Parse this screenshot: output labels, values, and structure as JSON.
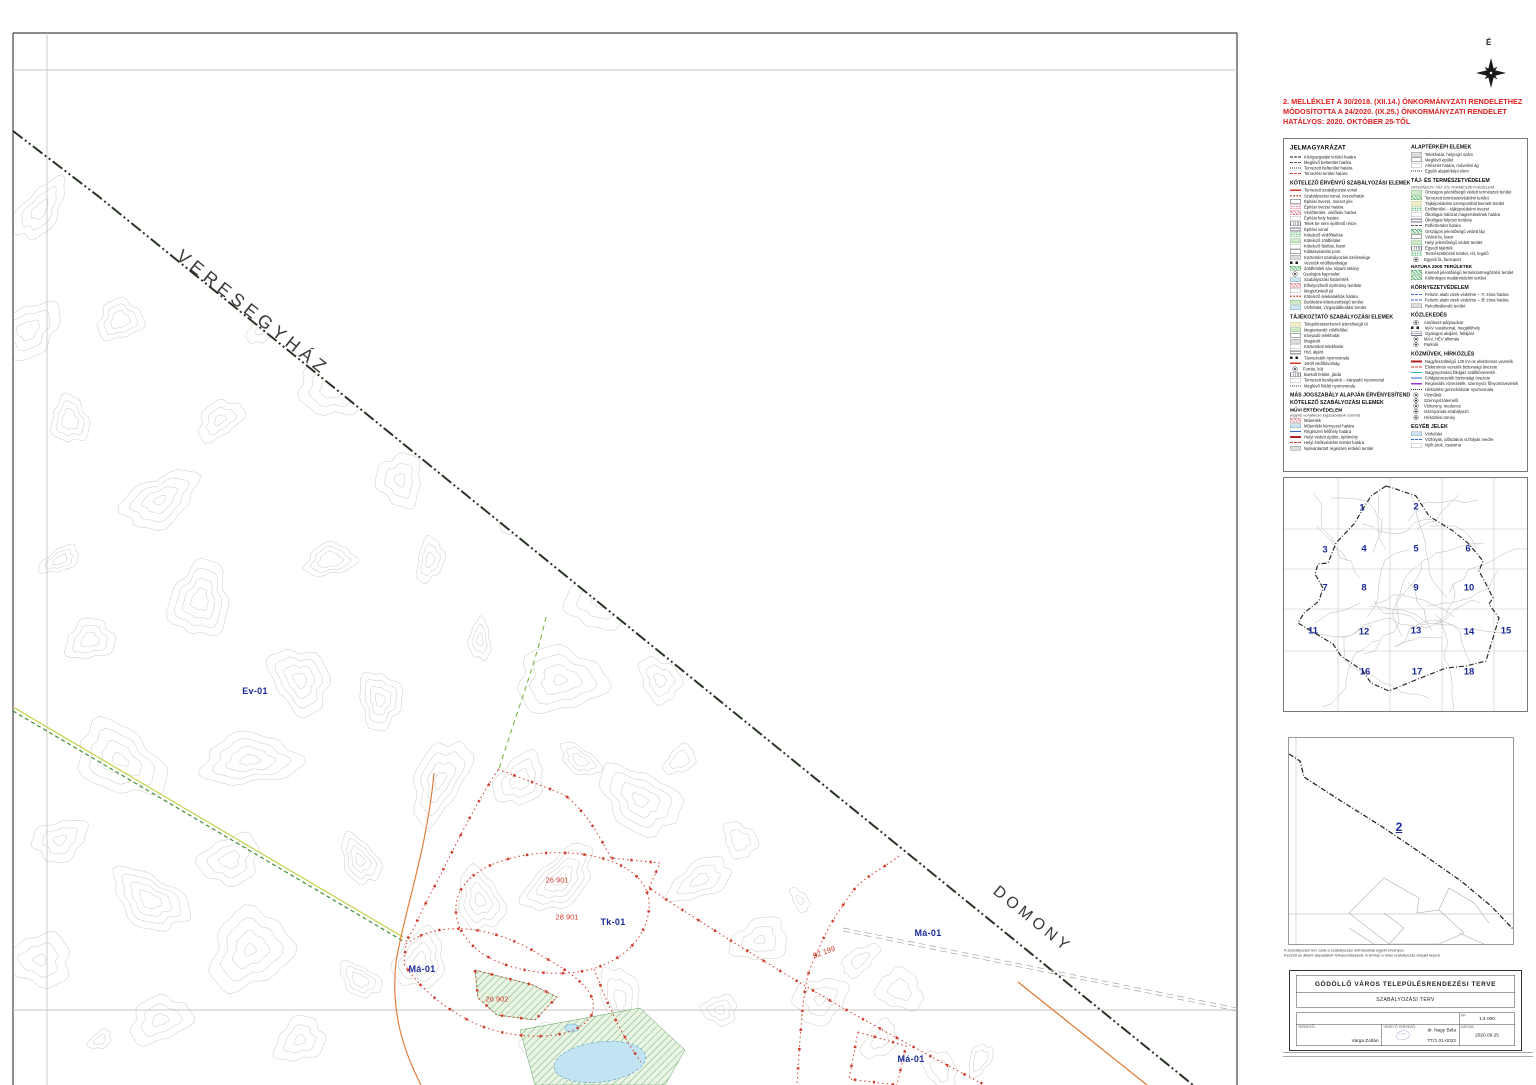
{
  "compass": {
    "north_label": "É"
  },
  "amendment_note": {
    "color": "#dd1f1f",
    "lines": [
      "2. MELLÉKLET A 30/2018. (XII.14.) ÖNKORMÁNYZATI RENDELETHEZ",
      "MÓDOSÍTOTTA A 24/2020. (IX.25.) ÖNKORMÁNYZATI RENDELET",
      "HATÁLYOS: 2020. OKTÓBER 25-TŐL"
    ]
  },
  "legend": {
    "title": "JELMAGYARÁZAT",
    "left_sections": [
      {
        "title": "",
        "items": [
          {
            "s": "sw-bdash1",
            "label": "Közigazgatási terület határa"
          },
          {
            "s": "sw-bdash2",
            "label": "Meglévő belterület határa"
          },
          {
            "s": "sw-bdash3",
            "label": "Tervezett belterület határa"
          },
          {
            "s": "sw-rdash",
            "label": "Tervezési terület határa"
          }
        ]
      },
      {
        "title": "KÖTELEZŐ ÉRVÉNYŰ SZABÁLYOZÁSI ELEMEK",
        "items": [
          {
            "s": "sw-rline",
            "label": "Tervezett szabályozási vonal"
          },
          {
            "s": "sw-rdot",
            "label": "Szabályozási vonal, övezethatár"
          },
          {
            "s": "sw-box",
            "label": "Építési övezet, övezet jele"
          },
          {
            "s": "sw-pinkdot",
            "label": "Építési övezet határa"
          },
          {
            "s": "sw-pinkhatch",
            "label": "Védőterület, védősáv határa"
          },
          {
            "s": "sw-dotbox",
            "label": "Építési hely határa"
          },
          {
            "s": "sw-vhatch",
            "label": "Telek be nem építhető része"
          },
          {
            "s": "sw-ladder",
            "label": "Építési vonal"
          },
          {
            "s": "sw-greendots",
            "label": "Kötelező védőfásítás"
          },
          {
            "s": "sw-greenfill",
            "label": "Kötelező zöldfelület"
          },
          {
            "s": "sw-dotbox",
            "label": "Kötelező fásítás, fasor"
          },
          {
            "s": "sw-box",
            "label": "Kilátásvédelmi pont"
          },
          {
            "s": "sw-graybox",
            "label": "Közterület szabályozási szélessége"
          },
          {
            "s": "sw-squares",
            "label": "Vezeték védőtávolsága"
          },
          {
            "s": "sw-greenhatch",
            "label": "Zöldfelületi sáv, tóparti sétány"
          },
          {
            "s": "sw-circle",
            "label": "Gyalogos kapcsolat"
          },
          {
            "s": "sw-bluebox",
            "label": "Szabályozási határérték"
          },
          {
            "s": "sw-pinkhatch",
            "label": "Elhelyezhető építmény területe"
          },
          {
            "s": "sw-dotbox",
            "label": "Megszüntető jel"
          },
          {
            "s": "sw-rdot",
            "label": "Kötelező telekalakítás határa"
          },
          {
            "s": "sw-greenfill",
            "label": "Beültetési kötelezettségű terület"
          },
          {
            "s": "sw-bluebox",
            "label": "Vízfelület, vízgazdálkodási terület"
          }
        ]
      },
      {
        "title": "TÁJÉKOZTATÓ SZABÁLYOZÁSI ELEMEK",
        "items": [
          {
            "s": "sw-yellowfill",
            "label": "Településszerkezeti jelentőségű út"
          },
          {
            "s": "sw-greenfill",
            "label": "Megtartandó zöldfelület"
          },
          {
            "s": "sw-box",
            "label": "Irányadó telekhatár"
          },
          {
            "s": "sw-graybox",
            "label": "Magánút"
          },
          {
            "s": "sw-dotbox",
            "label": "Közterületi telekhatár"
          },
          {
            "s": "sw-ladder",
            "label": "Híd, átjáró"
          },
          {
            "s": "sw-squares",
            "label": "Távvezeték nyomvonala"
          },
          {
            "s": "sw-rline",
            "label": "Jelölt védőtávolság"
          },
          {
            "s": "sw-circle",
            "label": "Forrás, kút"
          },
          {
            "s": "sw-vhatch",
            "label": "Burkolt felület, járda"
          },
          {
            "s": "sw-dotbox",
            "label": "Tervezett kerékpárút – irányadó nyomvonal"
          },
          {
            "s": "sw-bdash3",
            "label": "Meglévő földút nyomvonala"
          }
        ]
      },
      {
        "title": "MÁS JOGSZABÁLY ALAPJÁN ÉRVÉNYESÍTENDŐ",
        "title2": "KÖTELEZŐ SZABÁLYOZÁSI ELEMEK",
        "subtitle": "MŰVI ÉRTÉKVÉDELEM",
        "subnote": "(egyéb vonatkozó jogszabályok szerint)",
        "items": [
          {
            "s": "sw-pinkhatch",
            "label": "Műemlék"
          },
          {
            "s": "sw-bluebox",
            "label": "Műemléki környezet határa"
          },
          {
            "s": "sw-blueline",
            "label": "Régészeti lelőhely határa"
          },
          {
            "s": "sw-redthick",
            "label": "Helyi védett épület, építmény"
          },
          {
            "s": "sw-rdash",
            "label": "Helyi értékvédelmi terület határa"
          },
          {
            "s": "sw-graybox",
            "label": "Nyilvántartott régészeti érdekű terület"
          }
        ]
      }
    ],
    "right_sections": [
      {
        "title": "ALAPTÉRKÉPI ELEMEK",
        "items": [
          {
            "s": "sw-graybox",
            "label": "Telekhatár, helyrajzi szám"
          },
          {
            "s": "sw-box",
            "label": "Meglévő épület"
          },
          {
            "s": "sw-dotbox",
            "label": "Alrészlet határa, művelési ág"
          },
          {
            "s": "sw-bdash3",
            "label": "Egyéb alaptérképi elem"
          }
        ]
      },
      {
        "title": "TÁJ- ÉS TERMÉSZETVÉDELEM",
        "subnote": "ORSZÁGOS TÁJ- ÉS TERMÉSZETVÉDELEM",
        "items": [
          {
            "s": "sw-greenfill",
            "label": "Országos jelentőségű védett természeti terület"
          },
          {
            "s": "sw-greenhatch",
            "label": "Tervezett természetvédelmi terület"
          },
          {
            "s": "sw-yellowfill",
            "label": "Tájképvédelmi szempontból kiemelt terület"
          },
          {
            "s": "sw-greendots",
            "label": "Erdőterület – tájképvédelmi övezet"
          },
          {
            "s": "sw-dotbox",
            "label": "Ökológiai hálózat magterületének határa"
          },
          {
            "s": "sw-ladder",
            "label": "Ökológiai folyosó területe"
          },
          {
            "s": "sw-bdash2",
            "label": "Pufferterület határa"
          },
          {
            "s": "sw-greenhatch",
            "label": "Országos jelentőségű védett láp"
          },
          {
            "s": "sw-box",
            "label": "Védett fa, fasor"
          },
          {
            "s": "sw-greenfill",
            "label": "Helyi jelentőségű védett terület"
          },
          {
            "s": "sw-vhatch",
            "label": "Egyedi tájérték"
          },
          {
            "s": "sw-greendots",
            "label": "Természetközeli terület, rét, legelő"
          },
          {
            "s": "sw-circle",
            "label": "Egyedi fa, facsoport"
          }
        ]
      },
      {
        "title": "NATURA 2000 TERÜLETEK",
        "items": [
          {
            "s": "sw-greenhatch",
            "label": "Kiemelt jelentőségű természetmegőrzési terület"
          },
          {
            "s": "sw-greenhatch",
            "label": "Különleges madárvédelmi terület"
          }
        ]
      },
      {
        "title": "KÖRNYEZETVÉDELEM",
        "items": [
          {
            "s": "sw-bluedash",
            "label": "Felszín alatti vizek védelme – 'A' zóna határa"
          },
          {
            "s": "sw-bluedash",
            "label": "Felszín alatti vizek védelme – 'B' zóna határa"
          },
          {
            "s": "sw-graybox",
            "label": "Rekultiválandó terület"
          }
        ]
      },
      {
        "title": "KÖZLEKEDÉS",
        "items": [
          {
            "s": "sw-circle",
            "label": "Autóbusz-pályaudvar"
          },
          {
            "s": "sw-squares",
            "label": "MÁV vasútvonal, megállóhely"
          },
          {
            "s": "sw-ladder",
            "label": "Gyalogos aluljáró, felüljáró"
          },
          {
            "s": "sw-circle",
            "label": "MÁV, HÉV állomás"
          },
          {
            "s": "sw-circle",
            "label": "Parkoló"
          }
        ]
      },
      {
        "title": "KÖZMŰVEK, HÍRKÖZLÉS",
        "items": [
          {
            "s": "sw-redthick",
            "label": "Nagyfeszültségű 120 kV-os elektromos vezeték"
          },
          {
            "s": "sw-rdash",
            "label": "Elektromos vezeték biztonsági övezete"
          },
          {
            "s": "sw-cyanline",
            "label": "Nagynyomású földgáz szállítóvezeték"
          },
          {
            "s": "sw-blueline",
            "label": "Földgázvezeték biztonsági övezete"
          },
          {
            "s": "sw-purpleline",
            "label": "Regionális vízvezeték, szennyvíz főnyomóvezeték"
          },
          {
            "s": "sw-bdash3",
            "label": "Hírközlési gerinchálózat nyomvonala"
          },
          {
            "s": "sw-circle",
            "label": "Vízműkút"
          },
          {
            "s": "sw-circle",
            "label": "Szennyvízátemelő"
          },
          {
            "s": "sw-circle",
            "label": "Víztorony, medence"
          },
          {
            "s": "sw-circle",
            "label": "Gáznyomás-szabályozó"
          },
          {
            "s": "sw-circle",
            "label": "Hírközlési torony"
          }
        ]
      },
      {
        "title": "EGYÉB JELEK",
        "items": [
          {
            "s": "sw-bluebox",
            "label": "Vízfelület"
          },
          {
            "s": "sw-bluedash",
            "label": "Vízfolyás, időszakos vízfolyás medre"
          },
          {
            "s": "sw-dotbox",
            "label": "Nyílt árok, csatorna"
          }
        ]
      }
    ]
  },
  "overview_map": {
    "numbers": [
      {
        "n": "1",
        "x": 78,
        "y": 30
      },
      {
        "n": "2",
        "x": 132,
        "y": 29
      },
      {
        "n": "3",
        "x": 41,
        "y": 72
      },
      {
        "n": "4",
        "x": 80,
        "y": 71
      },
      {
        "n": "5",
        "x": 132,
        "y": 71
      },
      {
        "n": "6",
        "x": 184,
        "y": 71
      },
      {
        "n": "7",
        "x": 41,
        "y": 110
      },
      {
        "n": "8",
        "x": 80,
        "y": 110
      },
      {
        "n": "9",
        "x": 132,
        "y": 110
      },
      {
        "n": "10",
        "x": 185,
        "y": 110
      },
      {
        "n": "11",
        "x": 29,
        "y": 153
      },
      {
        "n": "12",
        "x": 80,
        "y": 154
      },
      {
        "n": "13",
        "x": 132,
        "y": 153
      },
      {
        "n": "14",
        "x": 185,
        "y": 154
      },
      {
        "n": "15",
        "x": 222,
        "y": 153
      },
      {
        "n": "16",
        "x": 81,
        "y": 194
      },
      {
        "n": "17",
        "x": 133,
        "y": 194
      },
      {
        "n": "18",
        "x": 185,
        "y": 194
      }
    ]
  },
  "locator_map": {
    "sheet_label": "2"
  },
  "notes": {
    "lines": [
      "A szabályozási terv csak a szabályozási előírásokkal együtt érvényes.",
      "Készült az állami alapadatok felhasználásával. A tervlap a helyi szabályozás alapját képezi."
    ]
  },
  "title_block": {
    "main_title": "GÖDÖLLŐ VÁROS TELEPÜLÉSRENDEZÉSI TERVE",
    "subtitle": "SZABÁLYOZÁSI TERV",
    "scale_label": "M=",
    "scale": "1:4 000",
    "designer_label": "TERVEZŐ:",
    "designer": "Varga Zoltán",
    "lead_label": "VEZETŐ TERVEZŐ:",
    "lead_name": "dr. Nagy Béla",
    "lead_reg": "TT/1 01-0022",
    "date_label": "DÁTUM:",
    "date": "2020.09.25"
  },
  "map": {
    "neighbor_labels": [
      {
        "text": "VERESEGYHÁZ"
      },
      {
        "text": "DOMONY"
      }
    ],
    "zone_labels": [
      {
        "text": "Ev-01"
      },
      {
        "text": "Má-01"
      },
      {
        "text": "Tk-01"
      },
      {
        "text": "Má-01"
      },
      {
        "text": "Má-01"
      }
    ],
    "parcel_labels": [
      {
        "text": "26 901"
      },
      {
        "text": "28 901"
      },
      {
        "text": "26 902"
      },
      {
        "text": "92 199"
      }
    ]
  },
  "colors": {
    "amendment_red": "#dd1f1f",
    "zone_blue": "#1a2a9c",
    "regulation_red": "#cf3b2a",
    "boundary_black": "#1d1d1b",
    "contour_gray": "#d2cfc9"
  }
}
